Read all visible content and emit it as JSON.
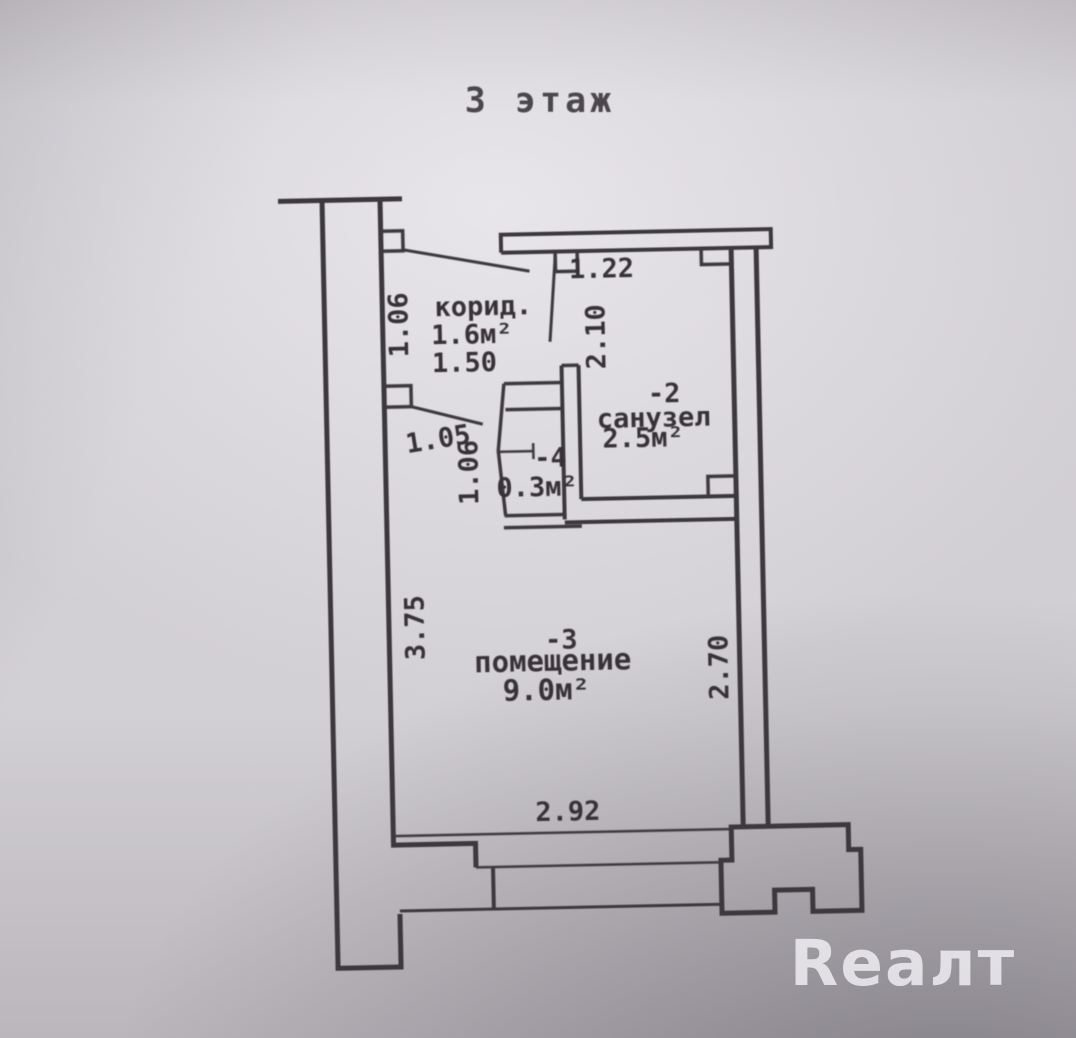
{
  "plan": {
    "floor_title": "3 этаж",
    "corridor": {
      "name": "корид.",
      "area": "1.6м²",
      "width": "1.50",
      "door_left": "1.06"
    },
    "bathroom": {
      "number": "-2",
      "name": "санузел",
      "area": "2.5м²",
      "depth": "2.10",
      "top_width": "1.22"
    },
    "closet": {
      "number": "-4",
      "area": "0.3м²",
      "door_width": "1.05",
      "door_left": "1.06"
    },
    "room": {
      "number": "-3",
      "name": "помещение",
      "area": "9.0м²",
      "dim_left": "3.75",
      "dim_right": "2.70",
      "dim_bottom": "2.92"
    }
  },
  "watermark": {
    "text": "Reaлт"
  },
  "colors": {
    "paper": "#d3d0d5",
    "line": "#3c383e",
    "text": "#373339",
    "watermark": "#f4f3f6"
  }
}
